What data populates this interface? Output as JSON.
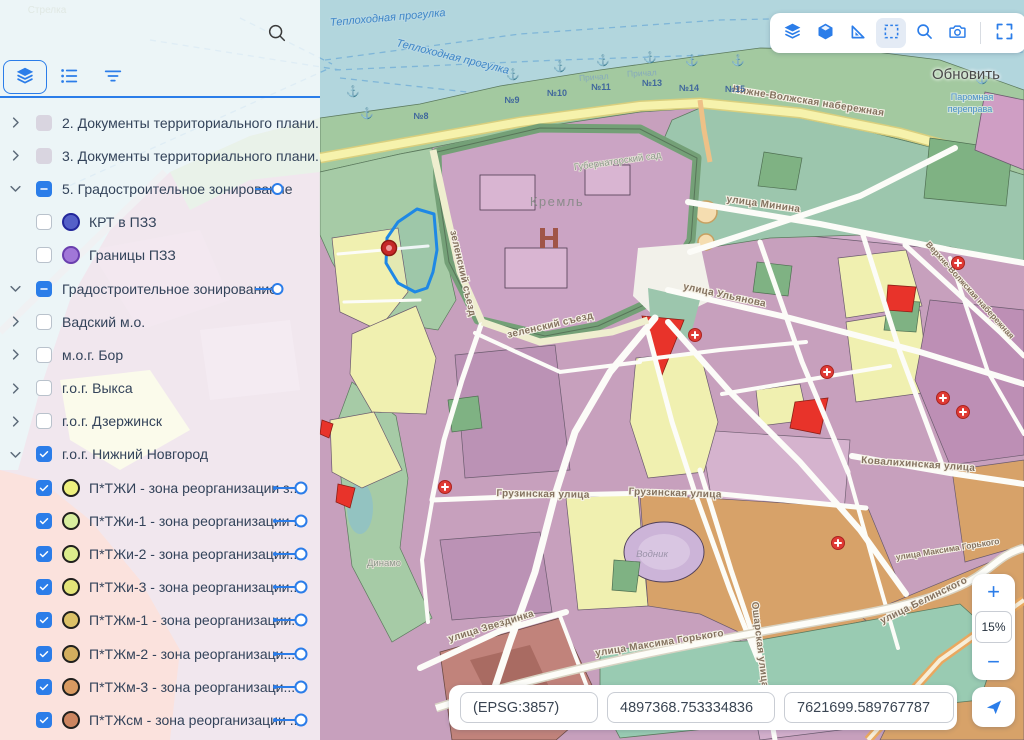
{
  "colors": {
    "accent": "#2b7de9",
    "water": "#b2d6dd",
    "zone_red": "#e8332a",
    "zone_yellow": "#f0f0b0",
    "zone_mauve": "#c7a0bd",
    "zone_tan": "#d7a269",
    "zone_green": "#9cc6ad"
  },
  "sidebar": {
    "search_icon": "search",
    "tabs": [
      {
        "icon": "layers",
        "active": true
      },
      {
        "icon": "list",
        "active": false
      },
      {
        "icon": "filter",
        "active": false
      }
    ],
    "items": [
      {
        "chevron": "right",
        "checkbox": "disabled",
        "swatch": null,
        "label": "2. Документы территориального плани...",
        "control": null
      },
      {
        "chevron": "right",
        "checkbox": "disabled",
        "swatch": null,
        "label": "3. Документы территориального плани...",
        "control": null
      },
      {
        "chevron": "down",
        "checkbox": "indeterminate",
        "swatch": null,
        "label": "5. Градостроительное зонирование",
        "control": "toggle"
      },
      {
        "chevron": null,
        "checkbox": "unchecked",
        "swatch": {
          "fill": "#5560c8",
          "border": "#23279b"
        },
        "label": "КРТ в ПЗЗ",
        "control": null
      },
      {
        "chevron": null,
        "checkbox": "unchecked",
        "swatch": {
          "fill": "#a177d8",
          "border": "#6a3fae"
        },
        "label": "Границы ПЗЗ",
        "control": null
      },
      {
        "chevron": "down",
        "checkbox": "indeterminate",
        "swatch": null,
        "label": "Градостроительное зонирование",
        "control": "toggle"
      },
      {
        "chevron": "right",
        "checkbox": "unchecked",
        "swatch": null,
        "label": "Вадский м.о.",
        "control": null
      },
      {
        "chevron": "right",
        "checkbox": "unchecked",
        "swatch": null,
        "label": "м.о.г. Бор",
        "control": null
      },
      {
        "chevron": "right",
        "checkbox": "unchecked",
        "swatch": null,
        "label": "г.о.г. Выкса",
        "control": null
      },
      {
        "chevron": "right",
        "checkbox": "unchecked",
        "swatch": null,
        "label": "г.о.г. Дзержинск",
        "control": null
      },
      {
        "chevron": "down",
        "checkbox": "checked",
        "swatch": null,
        "label": "г.о.г. Нижний Новгород",
        "control": null
      },
      {
        "chevron": null,
        "checkbox": "checked",
        "swatch": {
          "fill": "#eef07e",
          "border": "#20201e"
        },
        "label": "П*ТЖИ - зона реорганизации з...",
        "control": "slider"
      },
      {
        "chevron": null,
        "checkbox": "checked",
        "swatch": {
          "fill": "#d8ed9e",
          "border": "#20201e"
        },
        "label": "П*ТЖи-1 - зона реорганизации ...",
        "control": "slider"
      },
      {
        "chevron": null,
        "checkbox": "checked",
        "swatch": {
          "fill": "#dcec8c",
          "border": "#20201e"
        },
        "label": "П*ТЖи-2 - зона реорганизации...",
        "control": "slider"
      },
      {
        "chevron": null,
        "checkbox": "checked",
        "swatch": {
          "fill": "#e3e478",
          "border": "#20201e"
        },
        "label": "П*ТЖи-3 - зона реорганизации...",
        "control": "slider"
      },
      {
        "chevron": null,
        "checkbox": "checked",
        "swatch": {
          "fill": "#dcc167",
          "border": "#20201e"
        },
        "label": "П*ТЖм-1 - зона реорганизации...",
        "control": "slider"
      },
      {
        "chevron": null,
        "checkbox": "checked",
        "swatch": {
          "fill": "#d3ae5e",
          "border": "#20201e"
        },
        "label": "П*ТЖм-2 - зона реорганизаци...",
        "control": "slider"
      },
      {
        "chevron": null,
        "checkbox": "checked",
        "swatch": {
          "fill": "#d89a61",
          "border": "#20201e"
        },
        "label": "П*ТЖм-3 - зона реорганизаци...",
        "control": "slider"
      },
      {
        "chevron": null,
        "checkbox": "checked",
        "swatch": {
          "fill": "#cc8560",
          "border": "#20201e"
        },
        "label": "П*ТЖсм - зона реорганизации ...",
        "control": "slider"
      }
    ]
  },
  "toolbar": {
    "buttons": [
      {
        "icon": "layers",
        "active": false
      },
      {
        "icon": "cube",
        "active": false
      },
      {
        "icon": "ruler",
        "active": false
      },
      {
        "icon": "select-area",
        "active": true
      },
      {
        "icon": "search",
        "active": false
      },
      {
        "icon": "camera",
        "active": false
      },
      {
        "icon": "divider",
        "active": false
      },
      {
        "icon": "fullscreen",
        "active": false
      }
    ]
  },
  "map_overlay": {
    "refresh_label": "Обновить"
  },
  "zoom_control": {
    "zoom_in": "+",
    "level": "15%",
    "zoom_out": "−"
  },
  "coordinates": {
    "crs": "(EPSG:3857)",
    "x": "4897368.753334836",
    "y": "7621699.589767787"
  },
  "map": {
    "labels": [
      [
        "Теплоходная прогулка",
        388,
        21,
        -5,
        "t-water"
      ],
      [
        "Теплоходная прогулка",
        452,
        60,
        14,
        "t-water"
      ],
      [
        "Стрелка",
        47,
        13,
        0,
        "t-faint"
      ],
      [
        "Нижне-Волжская набережная",
        808,
        104,
        9,
        "t-street"
      ],
      [
        "Причал",
        594,
        80,
        -4,
        "t-berth-faint"
      ],
      [
        "Причал",
        642,
        76,
        -3,
        "t-berth-faint"
      ],
      [
        "Кремль",
        557,
        206,
        0,
        "t-place"
      ],
      [
        "Губернаторский сад",
        618,
        164,
        -8,
        "t-place-sm"
      ],
      [
        "зеленский съезд",
        460,
        274,
        77,
        "t-street"
      ],
      [
        "зеленский съезд",
        551,
        328,
        -13,
        "t-street"
      ],
      [
        "улица Минина",
        763,
        207,
        8,
        "t-street"
      ],
      [
        "улица Ульянова",
        724,
        298,
        12,
        "t-street"
      ],
      [
        "Верхне-Волжская набережная",
        968,
        292,
        48,
        "t-street-sm"
      ],
      [
        "Ковалихинская улица",
        918,
        467,
        4,
        "t-street"
      ],
      [
        "Грузинская улица",
        543,
        497,
        1,
        "t-street"
      ],
      [
        "Грузинская улица",
        675,
        496,
        2,
        "t-street"
      ],
      [
        "улица Звездинка",
        492,
        629,
        -17,
        "t-street"
      ],
      [
        "улица Максима Горького",
        660,
        646,
        -9,
        "t-street"
      ],
      [
        "улица Максима Горького",
        948,
        552,
        -9,
        "t-street-sm"
      ],
      [
        "улица Белинского",
        925,
        603,
        -26,
        "t-street"
      ],
      [
        "Ошарская улица",
        757,
        645,
        83,
        "t-street"
      ],
      [
        "Водник",
        652,
        557,
        0,
        "t-italic"
      ],
      [
        "Динамо",
        384,
        566,
        0,
        "t-place-sm"
      ],
      [
        "Паромная",
        972,
        100,
        0,
        "t-water-sm"
      ],
      [
        "переправа",
        970,
        112,
        0,
        "t-water-sm"
      ]
    ],
    "berths": [
      [
        "№8",
        421,
        119
      ],
      [
        "№9",
        512,
        103
      ],
      [
        "№10",
        557,
        96
      ],
      [
        "№11",
        601,
        90
      ],
      [
        "№13",
        652,
        86
      ],
      [
        "№14",
        689,
        91
      ],
      [
        "№15",
        735,
        92
      ]
    ],
    "medical_markers": [
      [
        445,
        487
      ],
      [
        695,
        335
      ],
      [
        827,
        372
      ],
      [
        943,
        398
      ],
      [
        963,
        412
      ],
      [
        958,
        263
      ],
      [
        838,
        543
      ],
      [
        926,
        697
      ]
    ],
    "anchors": [
      [
        353,
        95
      ],
      [
        367,
        117
      ],
      [
        513,
        78
      ],
      [
        560,
        70
      ],
      [
        603,
        64
      ],
      [
        650,
        61
      ],
      [
        692,
        64
      ],
      [
        738,
        64
      ],
      [
        982,
        82
      ]
    ],
    "selection_marker": [
      389,
      248
    ]
  }
}
